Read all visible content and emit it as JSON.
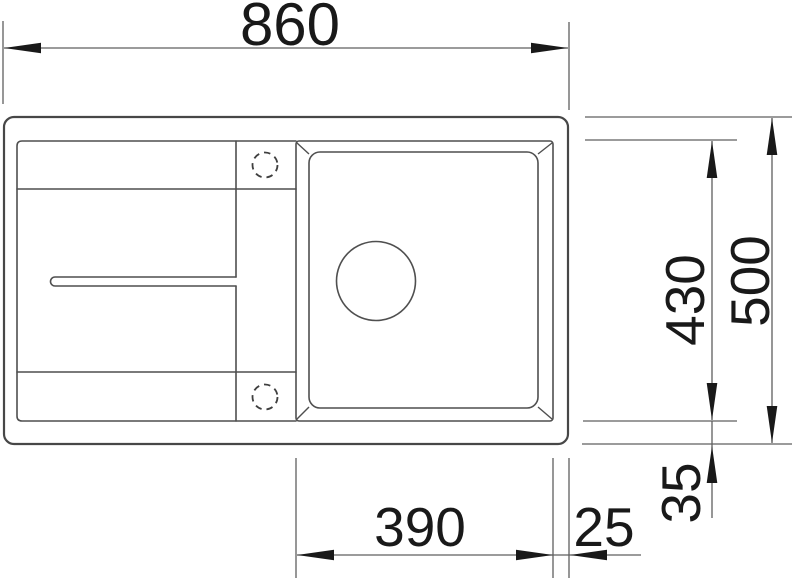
{
  "drawing": {
    "dimensions": {
      "overall_width": "860",
      "overall_depth": "500",
      "bowl_depth": "430",
      "bottom_offset": "35",
      "bowl_width": "390",
      "right_offset": "25"
    },
    "features": {
      "tap_hole_top": "optional-tap-hole",
      "tap_hole_bottom": "optional-tap-hole",
      "drain_hole": "drain-hole",
      "drain_groove": "drainboard-groove"
    },
    "colors": {
      "outline": "#474747",
      "dimension_lines": "#5f5f5f",
      "text": "#191919",
      "background": "#ffffff"
    }
  }
}
